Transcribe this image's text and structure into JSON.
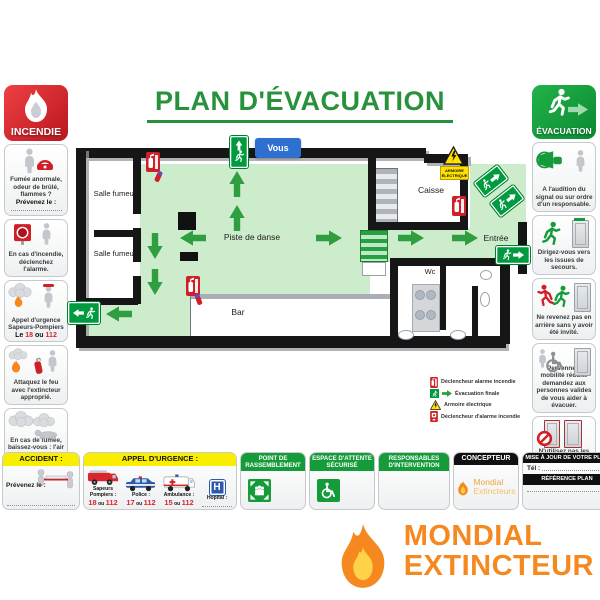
{
  "title": "PLAN D'ÉVACUATION",
  "incendie": {
    "badge": "INCENDIE",
    "p1_text": "Fumée anormale, odeur de brûlé, flammes ?",
    "p1_bold": "Prévenez le :",
    "p2_text": "En cas d'incendie, déclenchez l'alarme.",
    "p3_line1": "Appel d'urgence",
    "p3_line2": "Sapeurs-Pompiers",
    "p3_prefix": "Le",
    "p3_n1": "18",
    "p3_sep": "ou",
    "p3_n2": "112",
    "p4_text": "Attaquez le feu avec l'extincteur approprié.",
    "p5_text": "En cas de fumée, baissez-vous : l'air frais est près du sol."
  },
  "evacuation": {
    "badge": "ÉVACUATION",
    "p1_text": "A l'audition du signal ou sur ordre d'un responsable.",
    "p2_text": "Dirigez-vous vers les issues de secours.",
    "p3_text": "Ne revenez pas en arrière sans y avoir été invité.",
    "p4_text": "Personne à mobilité réduite demandez aux personnes valides de vous aider à évacuer.",
    "p5_text": "N'utilisez pas les ascenseurs ou les monte-charges."
  },
  "plan": {
    "vous": "Vous",
    "salle_fumeur_1": "Salle fumeur",
    "salle_fumeur_2": "Salle fumeur",
    "piste": "Piste de danse",
    "bar": "Bar",
    "caisse": "Caisse",
    "entree": "Entrée",
    "wc": "Wc",
    "armoire": "ARMOIRE ÉLECTRIQUE",
    "legend": [
      {
        "label": "Déclencheur alarme incendie"
      },
      {
        "label": "Évacuation finale"
      },
      {
        "label": "Armoire électrique"
      },
      {
        "label": "Déclencheur d'alarme incendie"
      }
    ]
  },
  "bottom": {
    "accident": {
      "header": "ACCIDENT :",
      "bold": "Prévenez le :"
    },
    "urgence": {
      "header": "APPEL D'URGENCE :",
      "hospital_letter": "H",
      "items": [
        {
          "label": "Sapeurs Pompiers :",
          "n1": "18",
          "sep": "ou",
          "n2": "112"
        },
        {
          "label": "Police :",
          "n1": "17",
          "sep": "ou",
          "n2": "112"
        },
        {
          "label": "Ambulance :",
          "n1": "15",
          "sep": "ou",
          "n2": "112"
        },
        {
          "label": "Hopital :"
        }
      ]
    },
    "rassemblement": {
      "header": "POINT DE RASSEMBLEMENT"
    },
    "attente": {
      "header": "ESPACE D'ATTENTE SÉCURISÉ"
    },
    "responsables": {
      "header": "RESPONSABLES D'INTERVENTION"
    },
    "concepteur": {
      "header": "CONCEPTEUR",
      "brand1": "Mondial",
      "brand2": "Extincteurs"
    },
    "mise_a_jour": {
      "header": "MISE À JOUR DE VOTRE PLAN",
      "tel": "Tél :",
      "ref": "RÉFÉRENCE PLAN"
    }
  },
  "logo": {
    "line1": "MONDIAL",
    "line2": "EXTINCTEUR"
  },
  "colors": {
    "green": "#28913c",
    "floor_green": "#cdeccb",
    "arrow_green": "#2f9e41",
    "exit_green": "#009b3e",
    "red": "#d1232a",
    "yellow": "#f9ee00",
    "orange": "#f5891f",
    "blue": "#2e6fd0"
  }
}
